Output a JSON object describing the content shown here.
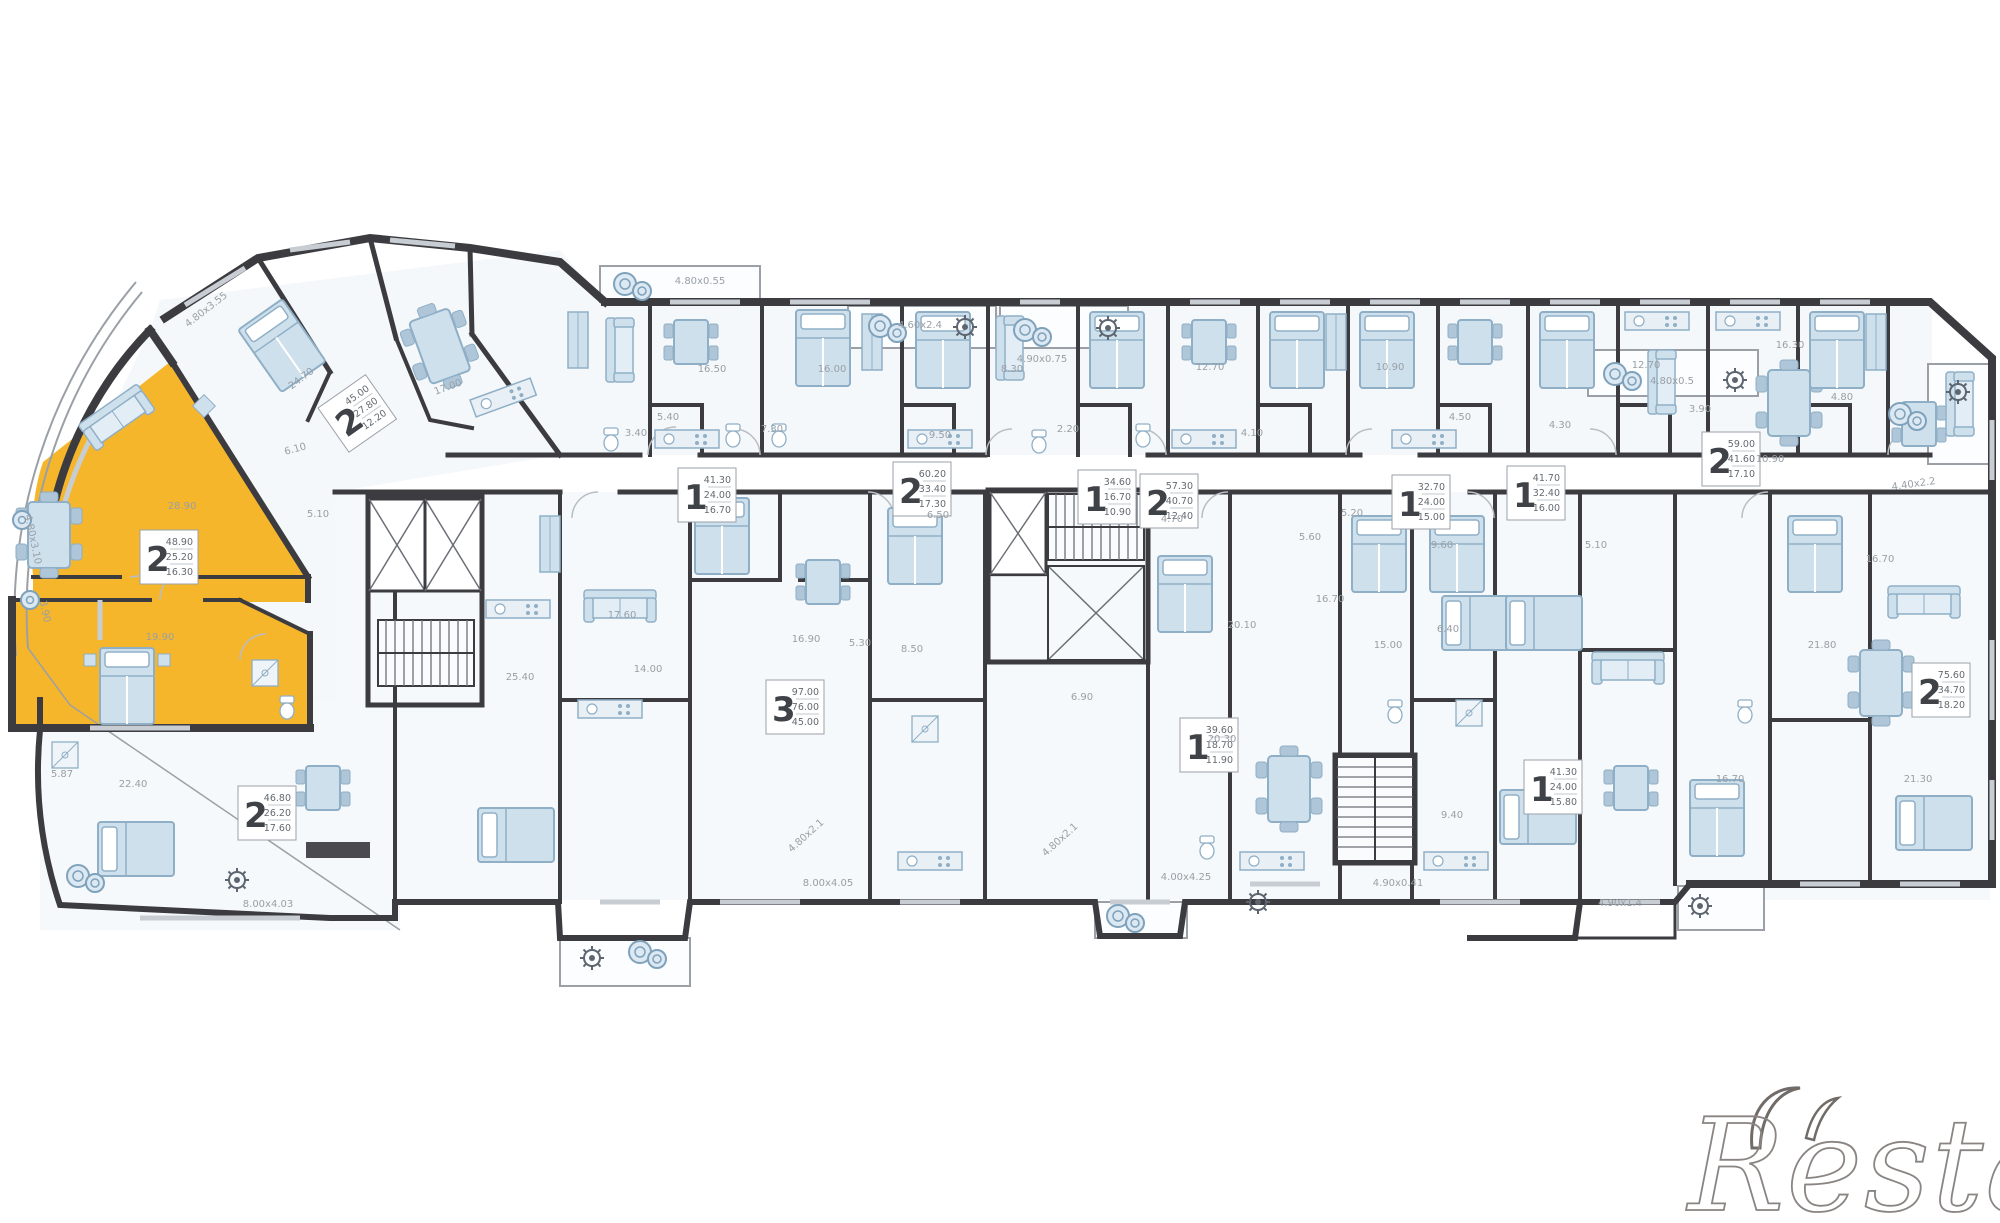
{
  "plan": {
    "title": "floor-plan",
    "highlight_color": "#F6B62B",
    "wall_color": "#3B3B40",
    "furniture_fill": "#CFE0ED",
    "furniture_stroke": "#8FAFC6",
    "watermark": {
      "text": "Restate"
    },
    "unit_labels": [
      {
        "digit": "2",
        "lines": [
          "48.90",
          "25.20",
          "16.30"
        ],
        "x": 140,
        "y": 530,
        "rot": 0
      },
      {
        "digit": "2",
        "lines": [
          "45.00",
          "27.80",
          "12.20"
        ],
        "x": 318,
        "y": 408,
        "rot": -35
      },
      {
        "digit": "2",
        "lines": [
          "46.80",
          "26.20",
          "17.60"
        ],
        "x": 238,
        "y": 786,
        "rot": 0
      },
      {
        "digit": "1",
        "lines": [
          "41.30",
          "24.00",
          "16.70"
        ],
        "x": 678,
        "y": 468,
        "rot": 0
      },
      {
        "digit": "2",
        "lines": [
          "60.20",
          "33.40",
          "17.30"
        ],
        "x": 893,
        "y": 462,
        "rot": 0
      },
      {
        "digit": "3",
        "lines": [
          "97.00",
          "76.00",
          "45.00"
        ],
        "x": 766,
        "y": 680,
        "rot": 0
      },
      {
        "digit": "1",
        "lines": [
          "34.60",
          "16.70",
          "10.90"
        ],
        "x": 1078,
        "y": 470,
        "rot": 0
      },
      {
        "digit": "2",
        "lines": [
          "57.30",
          "40.70",
          "12.40"
        ],
        "x": 1140,
        "y": 474,
        "rot": 0
      },
      {
        "digit": "1",
        "lines": [
          "32.70",
          "24.00",
          "15.00"
        ],
        "x": 1392,
        "y": 475,
        "rot": 0
      },
      {
        "digit": "1",
        "lines": [
          "41.70",
          "32.40",
          "16.00"
        ],
        "x": 1507,
        "y": 466,
        "rot": 0
      },
      {
        "digit": "1",
        "lines": [
          "39.60",
          "18.70",
          "11.90"
        ],
        "x": 1180,
        "y": 718,
        "rot": 0
      },
      {
        "digit": "1",
        "lines": [
          "41.30",
          "24.00",
          "15.80"
        ],
        "x": 1524,
        "y": 760,
        "rot": 0
      },
      {
        "digit": "2",
        "lines": [
          "59.00",
          "41.60",
          "17.10"
        ],
        "x": 1702,
        "y": 432,
        "rot": 0
      },
      {
        "digit": "2",
        "lines": [
          "75.60",
          "34.70",
          "18.20"
        ],
        "x": 1912,
        "y": 663,
        "rot": 0
      }
    ],
    "dim_labels": [
      {
        "t": "4.80x3.55",
        "x": 208,
        "y": 312,
        "r": -38
      },
      {
        "t": "4.80x3.10",
        "x": 30,
        "y": 540,
        "r": 78
      },
      {
        "t": "24.70",
        "x": 303,
        "y": 381,
        "r": -37
      },
      {
        "t": "17.00",
        "x": 449,
        "y": 390,
        "r": -20
      },
      {
        "t": "28.90",
        "x": 182,
        "y": 509,
        "r": 0
      },
      {
        "t": "6.10",
        "x": 296,
        "y": 452,
        "r": -15
      },
      {
        "t": "5.10",
        "x": 318,
        "y": 517,
        "r": 0
      },
      {
        "t": "19.90",
        "x": 160,
        "y": 640,
        "r": 0
      },
      {
        "t": "22.40",
        "x": 133,
        "y": 787,
        "r": 0
      },
      {
        "t": "5.87",
        "x": 62,
        "y": 777,
        "r": 0
      },
      {
        "t": "8.00x4.03",
        "x": 268,
        "y": 907,
        "r": 0
      },
      {
        "t": "4.80x0.55",
        "x": 700,
        "y": 284,
        "r": 0
      },
      {
        "t": "4.60x2.4",
        "x": 920,
        "y": 328,
        "r": 0
      },
      {
        "t": "4.90x0.75",
        "x": 1042,
        "y": 362,
        "r": 0
      },
      {
        "t": "4.80x0.5",
        "x": 1672,
        "y": 384,
        "r": 0
      },
      {
        "t": "4.40x2.2",
        "x": 1914,
        "y": 487,
        "r": -8
      },
      {
        "t": "16.50",
        "x": 712,
        "y": 372,
        "r": 0
      },
      {
        "t": "5.40",
        "x": 668,
        "y": 420,
        "r": 0
      },
      {
        "t": "3.40",
        "x": 636,
        "y": 436,
        "r": 0
      },
      {
        "t": "16.00",
        "x": 832,
        "y": 372,
        "r": 0
      },
      {
        "t": "7.30",
        "x": 772,
        "y": 432,
        "r": 0
      },
      {
        "t": "9.50",
        "x": 940,
        "y": 438,
        "r": 0
      },
      {
        "t": "8.30",
        "x": 1012,
        "y": 372,
        "r": 0
      },
      {
        "t": "2.20",
        "x": 1068,
        "y": 432,
        "r": 0
      },
      {
        "t": "12.70",
        "x": 1210,
        "y": 370,
        "r": 0
      },
      {
        "t": "4.10",
        "x": 1252,
        "y": 436,
        "r": 0
      },
      {
        "t": "10.90",
        "x": 1390,
        "y": 370,
        "r": 0
      },
      {
        "t": "4.50",
        "x": 1460,
        "y": 420,
        "r": 0
      },
      {
        "t": "4.30",
        "x": 1560,
        "y": 428,
        "r": 0
      },
      {
        "t": "12.70",
        "x": 1646,
        "y": 368,
        "r": 0
      },
      {
        "t": "16.30",
        "x": 1790,
        "y": 348,
        "r": 0
      },
      {
        "t": "4.80",
        "x": 1842,
        "y": 400,
        "r": 0
      },
      {
        "t": "3.90",
        "x": 1700,
        "y": 412,
        "r": 0
      },
      {
        "t": "10.90",
        "x": 1770,
        "y": 462,
        "r": 0
      },
      {
        "t": "25.40",
        "x": 520,
        "y": 680,
        "r": 0
      },
      {
        "t": "17.60",
        "x": 622,
        "y": 618,
        "r": 0
      },
      {
        "t": "16.90",
        "x": 806,
        "y": 642,
        "r": 0
      },
      {
        "t": "14.00",
        "x": 648,
        "y": 672,
        "r": 0
      },
      {
        "t": "5.30",
        "x": 860,
        "y": 646,
        "r": 0
      },
      {
        "t": "8.50",
        "x": 912,
        "y": 652,
        "r": 0
      },
      {
        "t": "6.90",
        "x": 1082,
        "y": 700,
        "r": 0
      },
      {
        "t": "6.50",
        "x": 938,
        "y": 518,
        "r": 0
      },
      {
        "t": "4.70",
        "x": 1172,
        "y": 522,
        "r": 0
      },
      {
        "t": "5.20",
        "x": 1352,
        "y": 516,
        "r": 0
      },
      {
        "t": "20.10",
        "x": 1242,
        "y": 628,
        "r": 0
      },
      {
        "t": "5.60",
        "x": 1310,
        "y": 540,
        "r": 0
      },
      {
        "t": "9.60",
        "x": 1442,
        "y": 548,
        "r": 0
      },
      {
        "t": "16.70",
        "x": 1330,
        "y": 602,
        "r": 0
      },
      {
        "t": "5.10",
        "x": 1596,
        "y": 548,
        "r": 0
      },
      {
        "t": "16.70",
        "x": 1880,
        "y": 562,
        "r": 0
      },
      {
        "t": "21.80",
        "x": 1822,
        "y": 648,
        "r": 0
      },
      {
        "t": "15.00",
        "x": 1388,
        "y": 648,
        "r": 0
      },
      {
        "t": "6.40",
        "x": 1448,
        "y": 632,
        "r": 0
      },
      {
        "t": "20.30",
        "x": 1222,
        "y": 742,
        "r": 0
      },
      {
        "t": "4.80x2.1",
        "x": 808,
        "y": 838,
        "r": -42
      },
      {
        "t": "4.80x2.1",
        "x": 1062,
        "y": 842,
        "r": -42
      },
      {
        "t": "4.90x1.4",
        "x": 1620,
        "y": 906,
        "r": 0
      },
      {
        "t": "4.00x4.25",
        "x": 1186,
        "y": 880,
        "r": 0
      },
      {
        "t": "8.00x4.05",
        "x": 828,
        "y": 886,
        "r": 0
      },
      {
        "t": "4.90x0.41",
        "x": 1398,
        "y": 886,
        "r": 0
      },
      {
        "t": "16.70",
        "x": 1730,
        "y": 782,
        "r": 0
      },
      {
        "t": "9.40",
        "x": 1452,
        "y": 818,
        "r": 0
      },
      {
        "t": "21.30",
        "x": 1918,
        "y": 782,
        "r": 0
      },
      {
        "t": "3.90",
        "x": 42,
        "y": 612,
        "r": 78
      }
    ]
  }
}
